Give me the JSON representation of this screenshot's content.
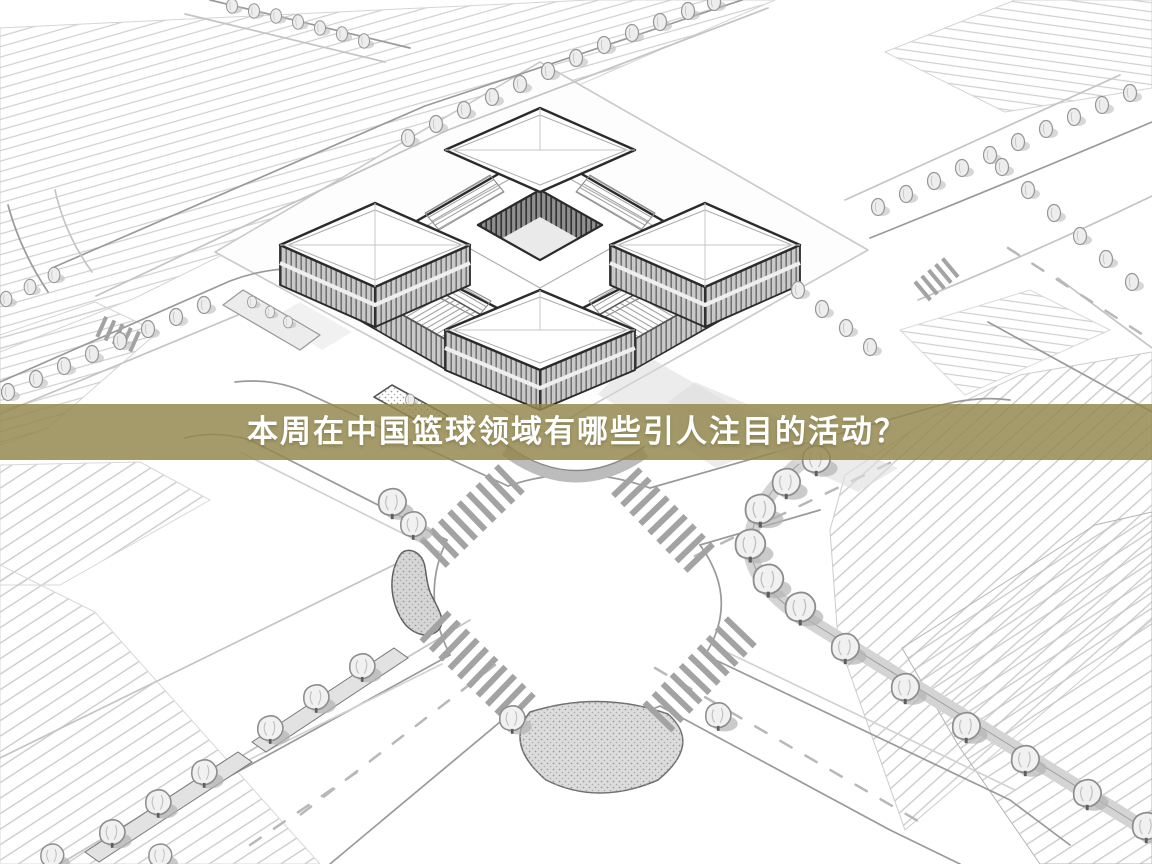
{
  "banner": {
    "title": "本周在中国篮球领域有哪些引人注目的活动？",
    "background_color": "#94884e",
    "background_opacity": 0.84,
    "text_color": "#ffffff"
  },
  "illustration": {
    "style": "black-and-white pencil-sketch aerial rendering",
    "scene": "courtyard building complex with corner pavilions, tree-lined roads, crosswalk intersection and plowed fields",
    "palette": {
      "background": "#ffffff",
      "building_line": "#2b2b2b",
      "road_line": "#9a9a9a",
      "field_line": "#cfcfcf",
      "facade_fill": "#c9c9c9",
      "tree_fill": "#f1f1f1",
      "shadow": "#b3b3b3"
    }
  }
}
